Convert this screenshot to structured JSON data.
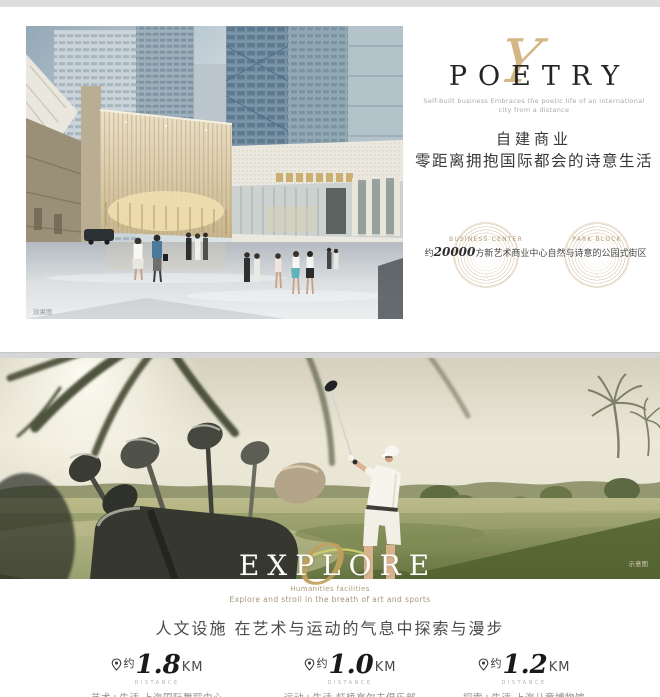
{
  "poetry_section": {
    "title": "POETRY",
    "script_letter": "Y",
    "subtitle_line1": "Self-built business Embraces the poetic life of an international",
    "subtitle_line2": "city from a distance",
    "heading_line1": "自建商业",
    "heading_line2": "零距离拥抱国际都会的诗意生活",
    "photo_watermark": "效果图",
    "badges": [
      {
        "label": "BUSINESS CENTER",
        "prefix": "约",
        "number": "20000",
        "suffix": "方新艺术商业中心"
      },
      {
        "label": "PARK BLOCK",
        "prefix": "",
        "number": "",
        "suffix": "自然与诗意的公园式街区"
      }
    ]
  },
  "explore_section": {
    "title": "EXPLORE",
    "script_letter": "O",
    "subtitle_line1": "Humanities facilities",
    "subtitle_line2": "Explore and stroll in the breath of art and sports",
    "heading": "人文设施 在艺术与运动的气息中探索与漫步",
    "photo_watermark": "示意图",
    "distances": [
      {
        "prefix": "约",
        "value": "1.8",
        "unit": "KM",
        "label": "DISTANCE",
        "description": "艺术+生活 上海国际舞蹈中心"
      },
      {
        "prefix": "约",
        "value": "1.0",
        "unit": "KM",
        "label": "DISTANCE",
        "description": "运动+生活 虹桥高尔夫俱乐部"
      },
      {
        "prefix": "约",
        "value": "1.2",
        "unit": "KM",
        "label": "DISTANCE",
        "description": "探索+生活 上海儿童博物馆"
      }
    ]
  },
  "colors": {
    "gold_accent": "#c2a05e",
    "dark_text": "#2b2b2b",
    "gray_text": "#9a9a9a",
    "tan_text": "#a69577"
  }
}
